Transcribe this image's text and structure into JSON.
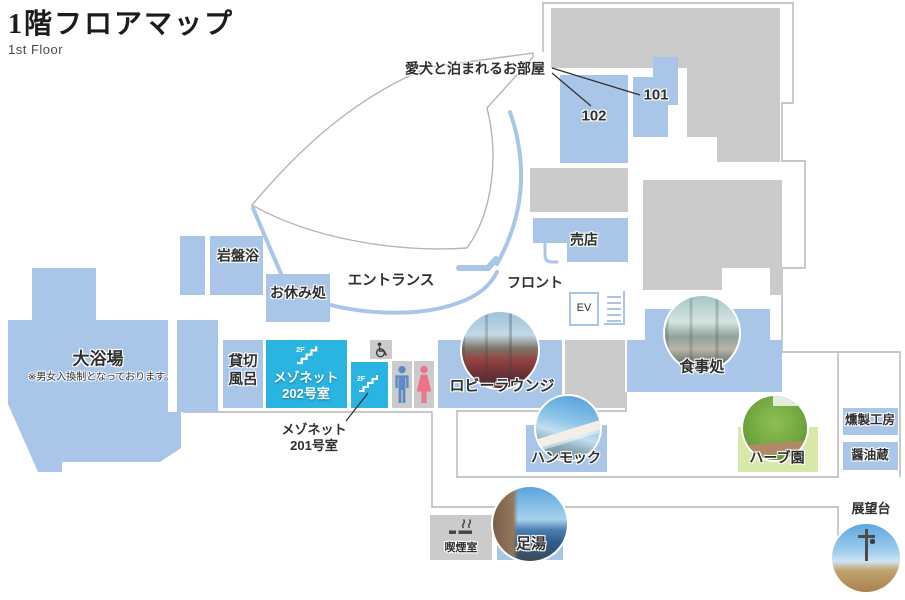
{
  "header": {
    "title": "1階フロアマップ",
    "subtitle": "1st Floor"
  },
  "colors": {
    "room_blue": "#a9c6e8",
    "highlight_cyan": "#29b4e2",
    "block_gray": "#cbcbcb",
    "herb_green": "#d7e8a8",
    "outline_gray": "#b5b5b5",
    "male_blue": "#5b8ac5",
    "female_pink": "#ee7186"
  },
  "annotations": {
    "dog_rooms": "愛犬と泊まれるお部屋",
    "maisonette201_line1": "メゾネット",
    "maisonette201_line2": "201号室"
  },
  "rooms": {
    "room102": "102",
    "room101": "101",
    "shop": "売店",
    "front_desk": "フロント",
    "elevator": "EV",
    "stone_sauna": "岩盤浴",
    "rest_area": "お休み処",
    "entrance": "エントランス",
    "large_bath": "大浴場",
    "large_bath_note": "※男女入換制となっております。",
    "private_bath_line1": "貸切",
    "private_bath_line2": "風呂",
    "maisonette202_line1": "メゾネット",
    "maisonette202_line2": "202号室",
    "floor2": "2F",
    "lobby_lounge": "ロビーラウンジ",
    "dining": "食事処",
    "hammock": "ハンモック",
    "herb_garden": "ハーブ園",
    "smokehouse": "燻製工房",
    "soy_sauce_cellar": "醤油蔵",
    "smoking_room": "喫煙室",
    "foot_bath": "足湯",
    "observatory": "展望台"
  }
}
